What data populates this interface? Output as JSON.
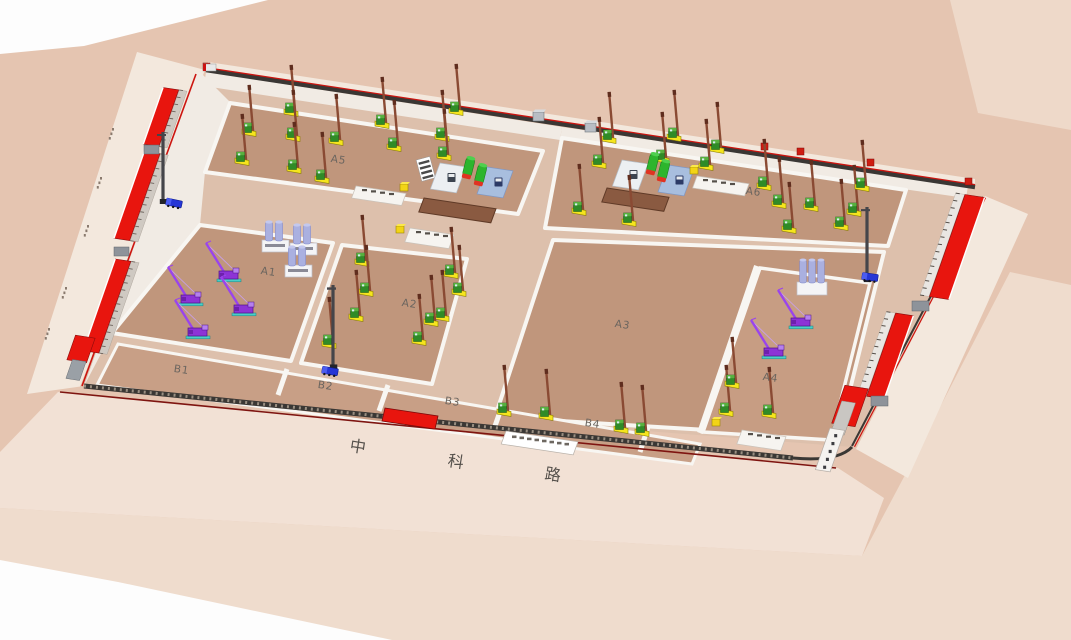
{
  "view": {
    "type": "3d-construction-site-plan"
  },
  "road": {
    "name": "中科路",
    "chars": [
      "中",
      "科",
      "路"
    ]
  },
  "zones": {
    "a1": "A1",
    "a2": "A2",
    "a3": "A3",
    "a4": "A4",
    "a5": "A5",
    "a6": "A6",
    "b1": "B1",
    "b2": "B2",
    "b3": "B3",
    "b4": "B4"
  },
  "equipment_names": {
    "piling_rig": "piling-rig",
    "crawler_crane": "crawler-crane",
    "storage_tank": "storage-tank",
    "dump_truck": "dump-truck",
    "tower_mast": "tower-mast",
    "batching_silos": "concrete-silo-building",
    "wash_rack": "wash-rack",
    "pad_white": "equipment-pad-white",
    "pad_blue": "equipment-pad-blue",
    "mud_pit": "mud-pit",
    "platform": "work-platform",
    "yellow_box": "material-box",
    "office_west": "site-office-building-west",
    "office_east": "site-office-building-east",
    "gate_canopy": "gate-canopy",
    "sign_panel": "wall-sign-panel",
    "gate_house": "gate-house"
  },
  "equipment_counts": {
    "piling_rigs": 43,
    "crawler_cranes": 6,
    "storage_tanks": 4,
    "dump_trucks": 3,
    "tower_masts": 3,
    "silo_buildings": 4
  },
  "colors": {
    "ground_base": "#e5c5b1",
    "ground_pale": "#efdccd",
    "ground_pale2": "#eed9c9",
    "road_light": "#f3e8dd",
    "road_south": "#f2e1d5",
    "site_base": "#ddc0ac",
    "site_edge_light": "#f1ebe4",
    "zone_brown": "#c0967c",
    "zone_brown2": "#c79d83",
    "zone_b": "#c89f86",
    "road_line_white": "#f8f6f2",
    "wall_dark": "#3a3734",
    "wall_red": "#cc1510",
    "roof_red": "#e8150e",
    "rig_yellow": "#f5e51e",
    "rig_green": "#2f8b27",
    "rig_mast": "#8a4a33",
    "crane_purple": "#8d33d6",
    "crane_track": "#49cfc8",
    "tank_green": "#2db52d",
    "tank_cap": "#e03322",
    "truck_blue": "#2636d6",
    "silo_lavender": "#aab0e0",
    "pad_white": "#eceff2",
    "pad_blue": "#a8bede",
    "pit_brown": "#8a5a41",
    "platform_white": "#f6f4f0",
    "cube_yellow": "#f2d416",
    "label_gray": "#6b655f",
    "road_text": "#55504b"
  }
}
